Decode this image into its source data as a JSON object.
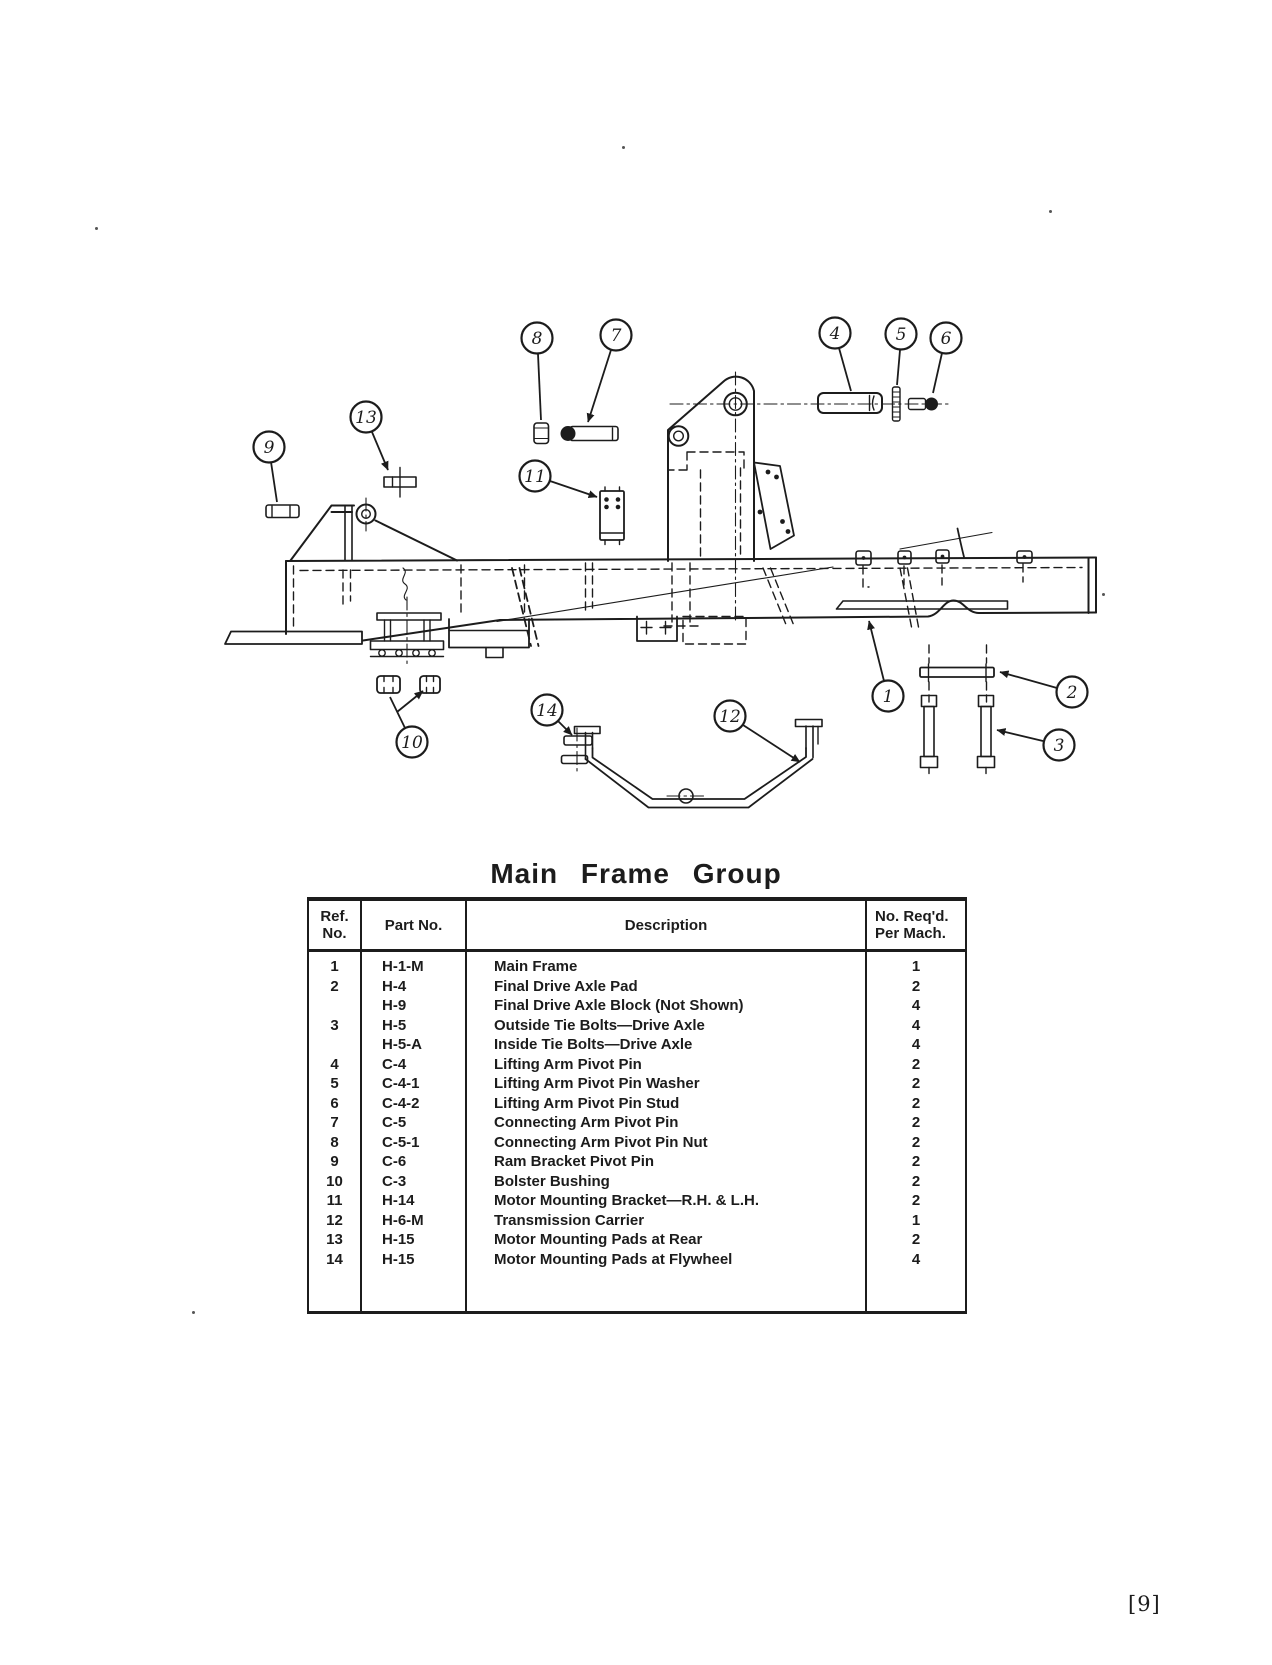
{
  "colors": {
    "ink": "#1c1c1c",
    "paper": "#ffffff"
  },
  "page": {
    "title": "Main Frame Group",
    "page_number": "[9]"
  },
  "table": {
    "headers": {
      "ref": [
        "Ref.",
        "No."
      ],
      "part": [
        "Part No."
      ],
      "desc": [
        "Description"
      ],
      "qty": [
        "No. Req'd.",
        "Per Mach."
      ]
    },
    "rows": [
      {
        "ref": "1",
        "part": "H-1-M",
        "desc": "Main Frame",
        "qty": "1"
      },
      {
        "ref": "2",
        "part": "H-4",
        "desc": "Final Drive Axle Pad",
        "qty": "2"
      },
      {
        "ref": "",
        "part": "H-9",
        "desc": "Final Drive Axle Block (Not Shown)",
        "qty": "4"
      },
      {
        "ref": "3",
        "part": "H-5",
        "desc": "Outside Tie Bolts—Drive Axle",
        "qty": "4"
      },
      {
        "ref": "",
        "part": "H-5-A",
        "desc": "Inside Tie Bolts—Drive Axle",
        "qty": "4"
      },
      {
        "ref": "4",
        "part": "C-4",
        "desc": "Lifting Arm Pivot Pin",
        "qty": "2"
      },
      {
        "ref": "5",
        "part": "C-4-1",
        "desc": "Lifting Arm Pivot Pin Washer",
        "qty": "2"
      },
      {
        "ref": "6",
        "part": "C-4-2",
        "desc": "Lifting Arm Pivot Pin Stud",
        "qty": "2"
      },
      {
        "ref": "7",
        "part": "C-5",
        "desc": "Connecting Arm Pivot Pin",
        "qty": "2"
      },
      {
        "ref": "8",
        "part": "C-5-1",
        "desc": "Connecting Arm Pivot Pin Nut",
        "qty": "2"
      },
      {
        "ref": "9",
        "part": "C-6",
        "desc": "Ram Bracket Pivot Pin",
        "qty": "2"
      },
      {
        "ref": "10",
        "part": "C-3",
        "desc": "Bolster Bushing",
        "qty": "2"
      },
      {
        "ref": "11",
        "part": "H-14",
        "desc": "Motor Mounting Bracket—R.H. & L.H.",
        "qty": "2"
      },
      {
        "ref": "12",
        "part": "H-6-M",
        "desc": "Transmission Carrier",
        "qty": "1"
      },
      {
        "ref": "13",
        "part": "H-15",
        "desc": "Motor Mounting Pads at Rear",
        "qty": "2"
      },
      {
        "ref": "14",
        "part": "H-15",
        "desc": "Motor Mounting Pads at Flywheel",
        "qty": "4"
      }
    ]
  },
  "figure": {
    "callouts": [
      {
        "n": "1",
        "cx": 888,
        "cy": 696,
        "leads": [
          {
            "pts": [
              [
                884,
                681
              ],
              [
                869,
                621
              ]
            ],
            "arrow": true
          }
        ]
      },
      {
        "n": "2",
        "cx": 1072,
        "cy": 692,
        "leads": [
          {
            "pts": [
              [
                1057,
                688
              ],
              [
                1000,
                672
              ]
            ],
            "arrow": true
          }
        ]
      },
      {
        "n": "3",
        "cx": 1059,
        "cy": 745,
        "leads": [
          {
            "pts": [
              [
                1043,
                741
              ],
              [
                997,
                730
              ]
            ],
            "arrow": true
          }
        ]
      },
      {
        "n": "4",
        "cx": 835,
        "cy": 333,
        "leads": [
          {
            "pts": [
              [
                839,
                348
              ],
              [
                851,
                391
              ]
            ],
            "arrow": false
          }
        ]
      },
      {
        "n": "5",
        "cx": 901,
        "cy": 334,
        "leads": [
          {
            "pts": [
              [
                900,
                350
              ],
              [
                897,
                385
              ]
            ],
            "arrow": false
          }
        ]
      },
      {
        "n": "6",
        "cx": 946,
        "cy": 338,
        "leads": [
          {
            "pts": [
              [
                942,
                353
              ],
              [
                933,
                393
              ]
            ],
            "arrow": false
          }
        ]
      },
      {
        "n": "7",
        "cx": 616,
        "cy": 335,
        "leads": [
          {
            "pts": [
              [
                611,
                350
              ],
              [
                588,
                422
              ]
            ],
            "arrow": true
          }
        ]
      },
      {
        "n": "8",
        "cx": 537,
        "cy": 338,
        "leads": [
          {
            "pts": [
              [
                538,
                354
              ],
              [
                541,
                420
              ]
            ],
            "arrow": false
          }
        ]
      },
      {
        "n": "9",
        "cx": 269,
        "cy": 447,
        "leads": [
          {
            "pts": [
              [
                271,
                462
              ],
              [
                277,
                502
              ]
            ],
            "arrow": false
          }
        ]
      },
      {
        "n": "10",
        "cx": 412,
        "cy": 742,
        "leads": [
          {
            "pts": [
              [
                405,
                728
              ],
              [
                390,
                697
              ]
            ],
            "arrow": false
          },
          {
            "pts": [
              [
                397,
                712
              ],
              [
                423,
                691
              ]
            ],
            "arrow": true
          }
        ]
      },
      {
        "n": "11",
        "cx": 535,
        "cy": 476,
        "leads": [
          {
            "pts": [
              [
                550,
                481
              ],
              [
                597,
                497
              ]
            ],
            "arrow": true
          }
        ]
      },
      {
        "n": "12",
        "cx": 730,
        "cy": 716,
        "leads": [
          {
            "pts": [
              [
                743,
                725
              ],
              [
                800,
                762
              ]
            ],
            "arrow": true
          }
        ]
      },
      {
        "n": "13",
        "cx": 366,
        "cy": 417,
        "leads": [
          {
            "pts": [
              [
                372,
                432
              ],
              [
                388,
                470
              ]
            ],
            "arrow": true
          }
        ]
      },
      {
        "n": "14",
        "cx": 547,
        "cy": 710,
        "leads": [
          {
            "pts": [
              [
                558,
                721
              ],
              [
                572,
                735
              ]
            ],
            "arrow": true
          }
        ]
      }
    ]
  }
}
